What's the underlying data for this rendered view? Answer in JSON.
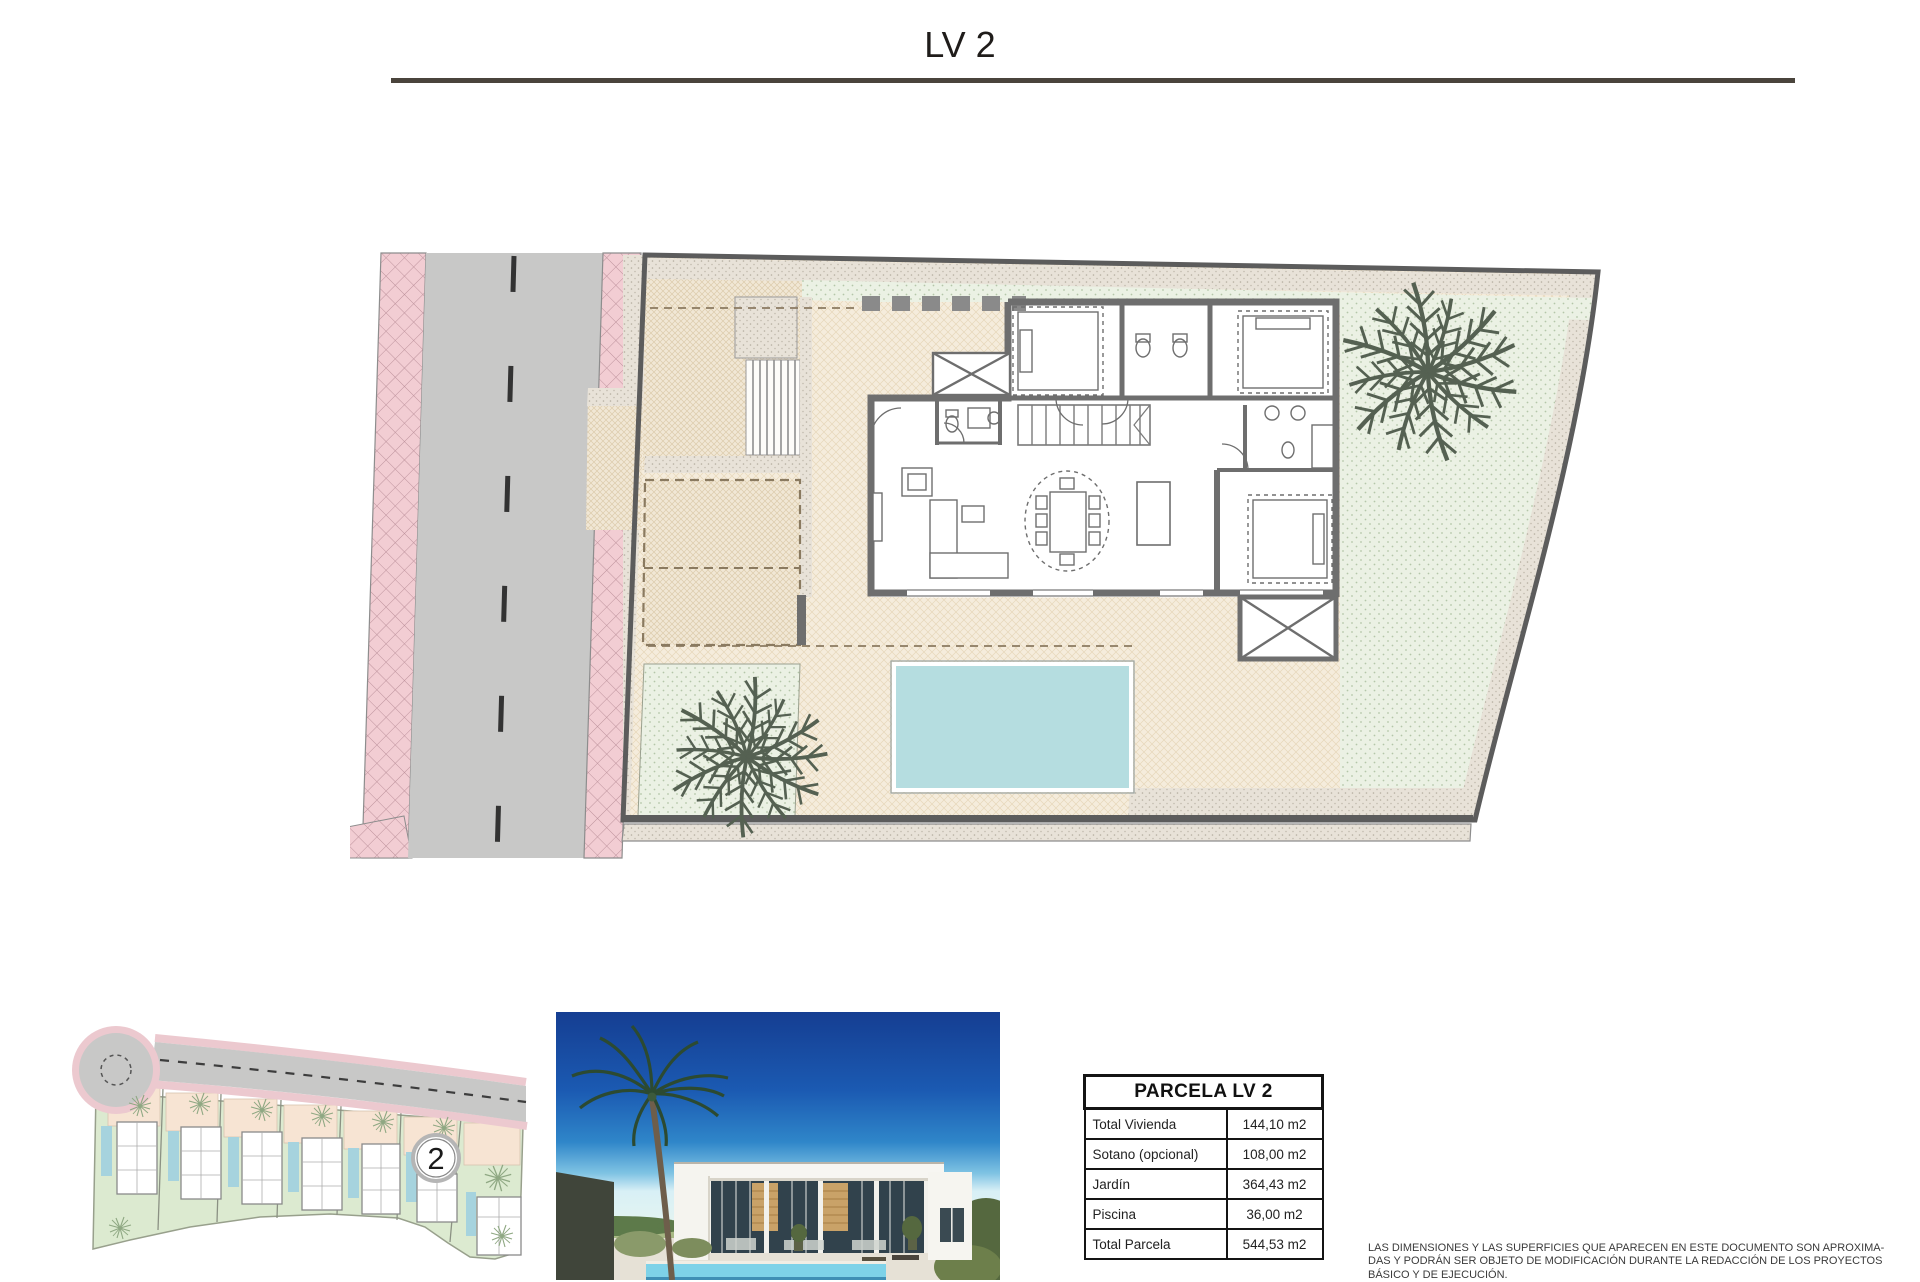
{
  "page": {
    "title": "LV 2"
  },
  "overview_map": {
    "plot_badge": "2"
  },
  "parcel_table": {
    "title": "PARCELA LV 2",
    "rows": [
      {
        "label": "Total Vivienda",
        "value": "144,10 m2"
      },
      {
        "label": "Sotano (opcional)",
        "value": "108,00 m2"
      },
      {
        "label": "Jardín",
        "value": "364,43 m2"
      },
      {
        "label": "Piscina",
        "value": "36,00 m2"
      },
      {
        "label": "Total Parcela",
        "value": "544,53 m2"
      }
    ]
  },
  "disclaimer": {
    "line1": "LAS DIMENSIONES Y LAS SUPERFICIES QUE APARECEN EN ESTE DOCUMENTO SON APROXIMA-",
    "line2": "DAS Y PODRÁN SER OBJETO DE MODIFICACIÓN DURANTE LA REDACCIÓN DE LOS PROYECTOS",
    "line3": "BÁSICO Y DE EJECUCIÓN."
  },
  "colors": {
    "road_gray": "#c8c8c7",
    "sidewalk_pink": "#f2cdd3",
    "garden_green": "#ebf1e4",
    "terrace_beige": "#f5ecdc",
    "gravel": "#e8e2d8",
    "pool_blue": "#b5dde0",
    "wall_gray": "#6e6e6e",
    "boundary_gray": "#5c5c5c",
    "sky_blue": "#173f95"
  }
}
